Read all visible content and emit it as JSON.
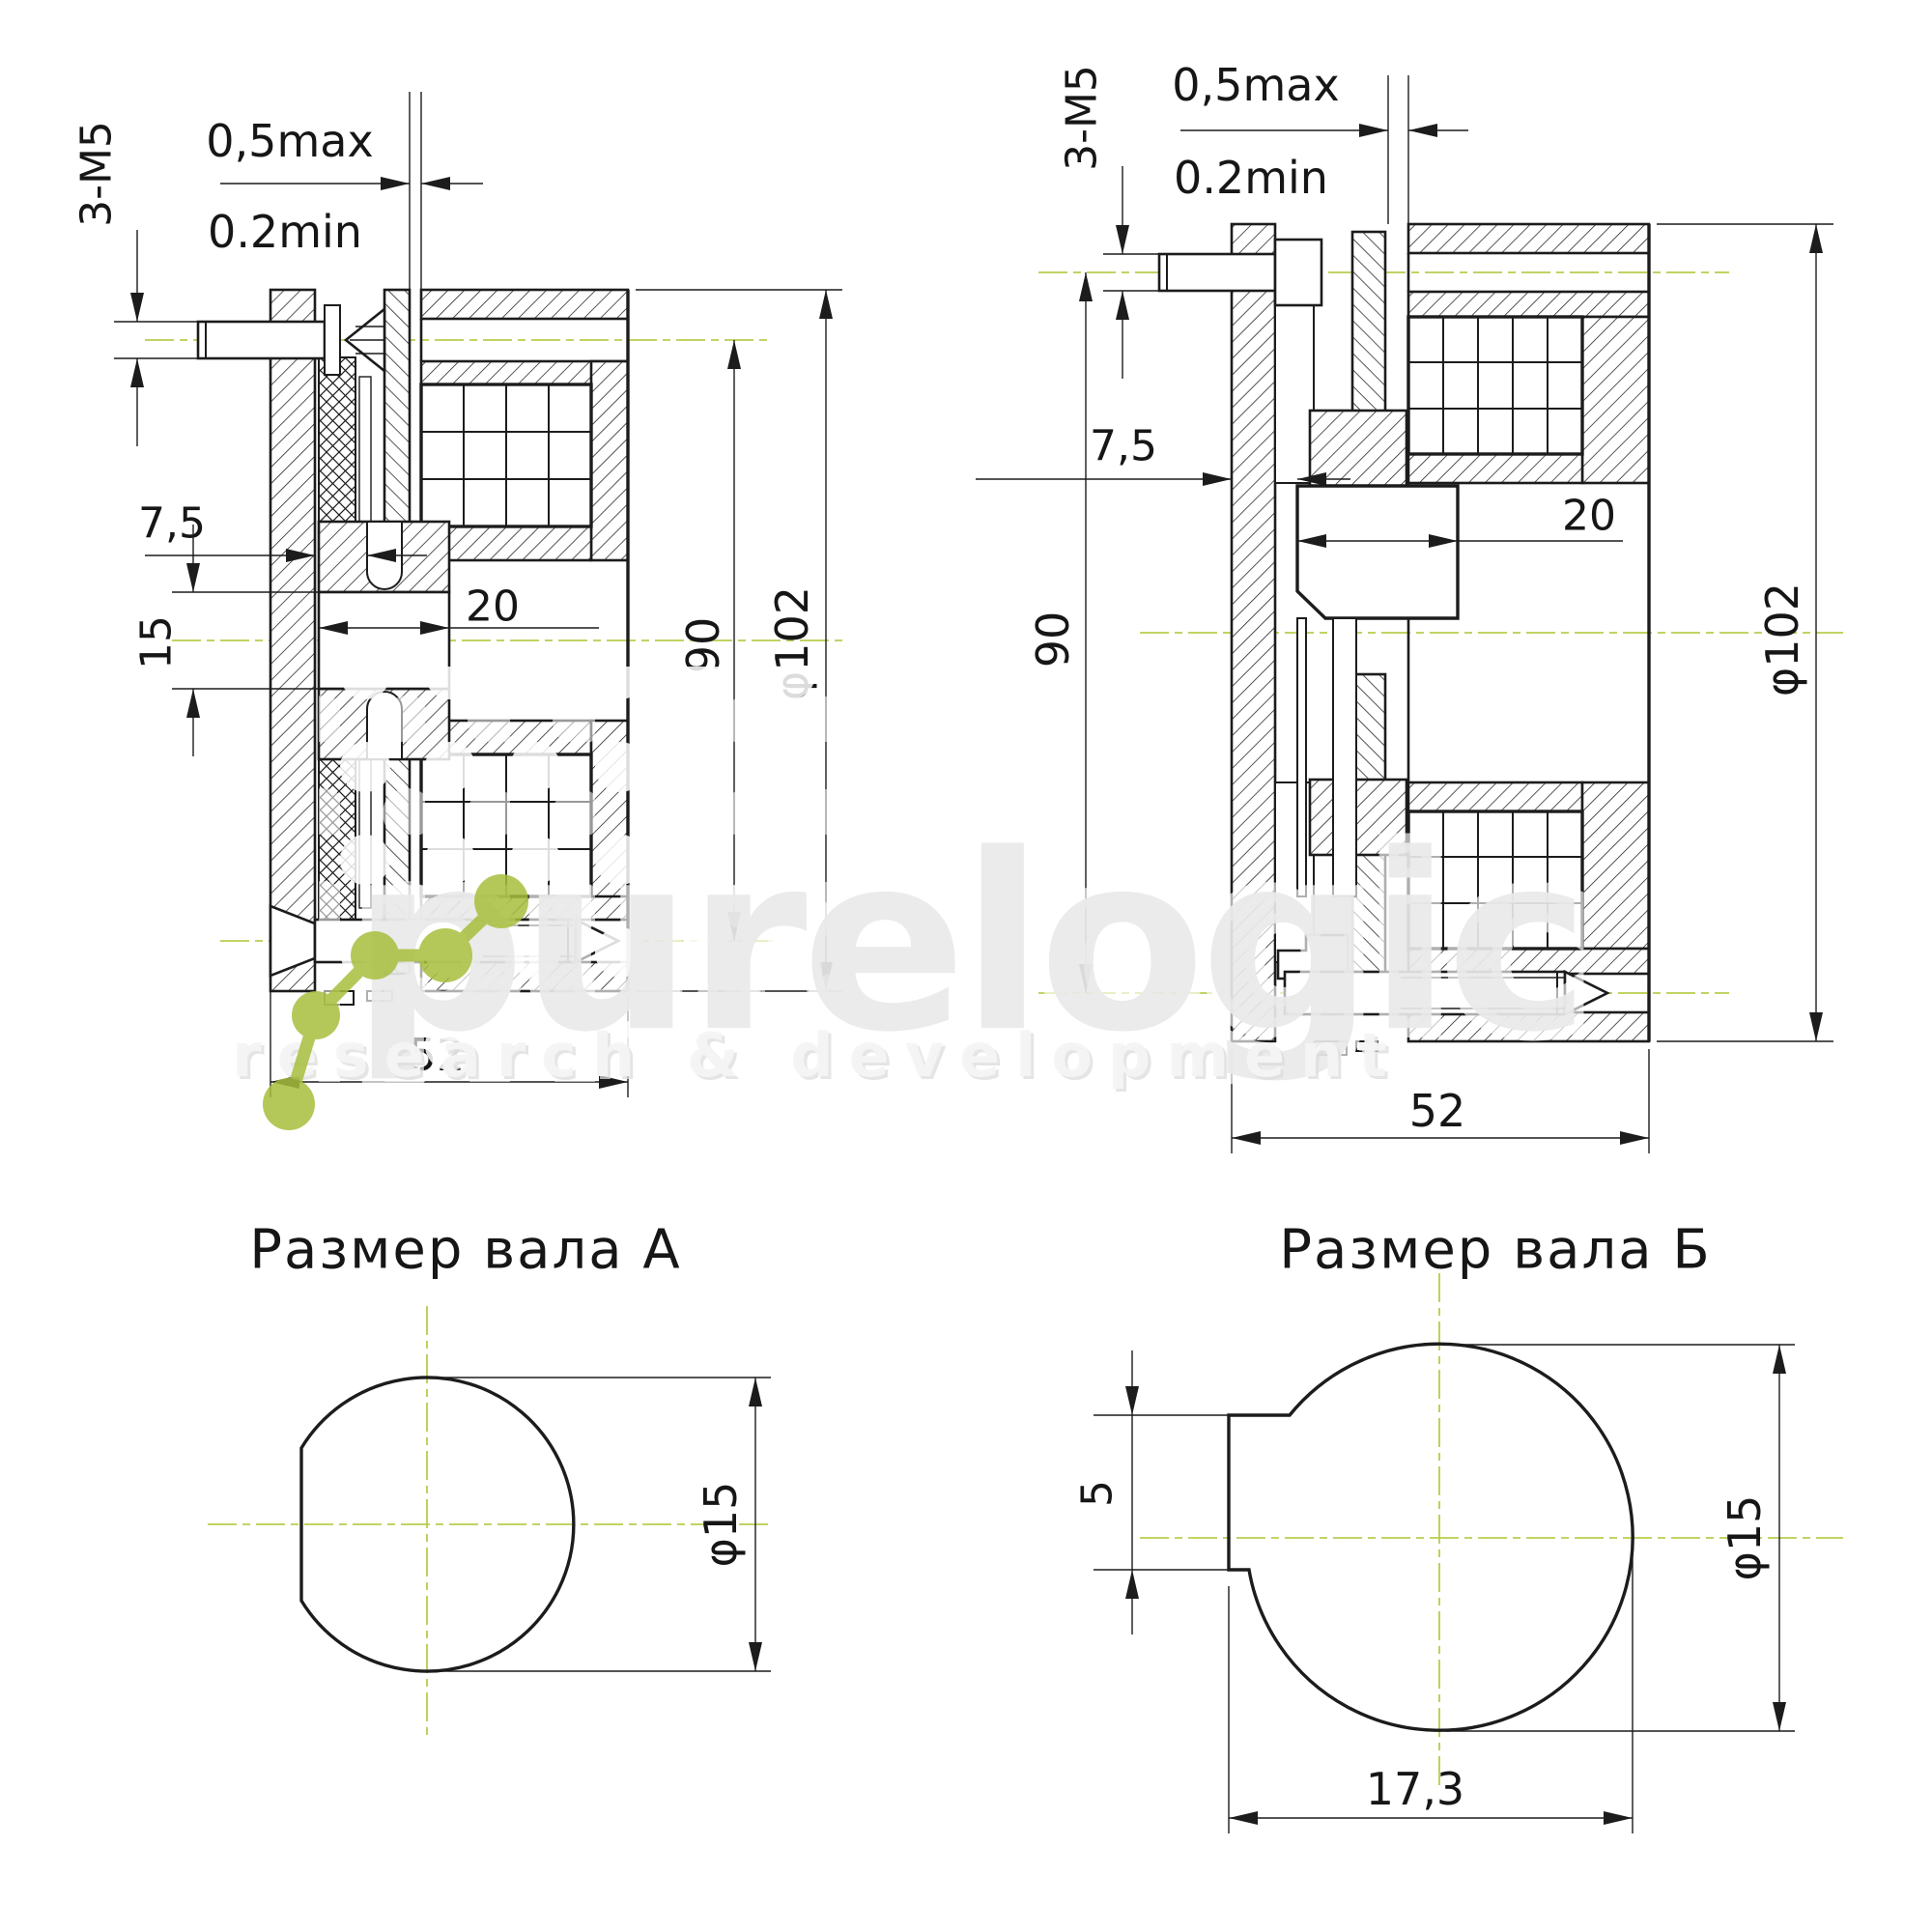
{
  "drawing": {
    "type": "electromagnetic-brake-cross-sections",
    "line_color": "#1c1c1c",
    "centerline_color": "#b6ce4d"
  },
  "left_view": {
    "bolt_spec": "3-M5",
    "gap_max": "0,5max",
    "gap_min": "0.2min",
    "offset": "7,5",
    "bore_width": "15",
    "hub_length": "20",
    "bolt_circle": "90",
    "outer_diameter": "φ102",
    "total_length": "52"
  },
  "right_view": {
    "bolt_spec": "3-M5",
    "gap_max": "0,5max",
    "gap_min": "0.2min",
    "offset": "7,5",
    "hub_length": "20",
    "bolt_circle": "90",
    "outer_diameter": "φ102",
    "total_length": "52"
  },
  "shaft_a": {
    "title": "Размер вала А",
    "diameter": "φ15"
  },
  "shaft_b": {
    "title": "Размер вала Б",
    "key_width": "5",
    "flat_width": "17,3",
    "diameter": "φ15"
  },
  "watermark": {
    "brand": "purelogic",
    "tagline": "research & development",
    "logo_color": "#a7bf3e"
  }
}
